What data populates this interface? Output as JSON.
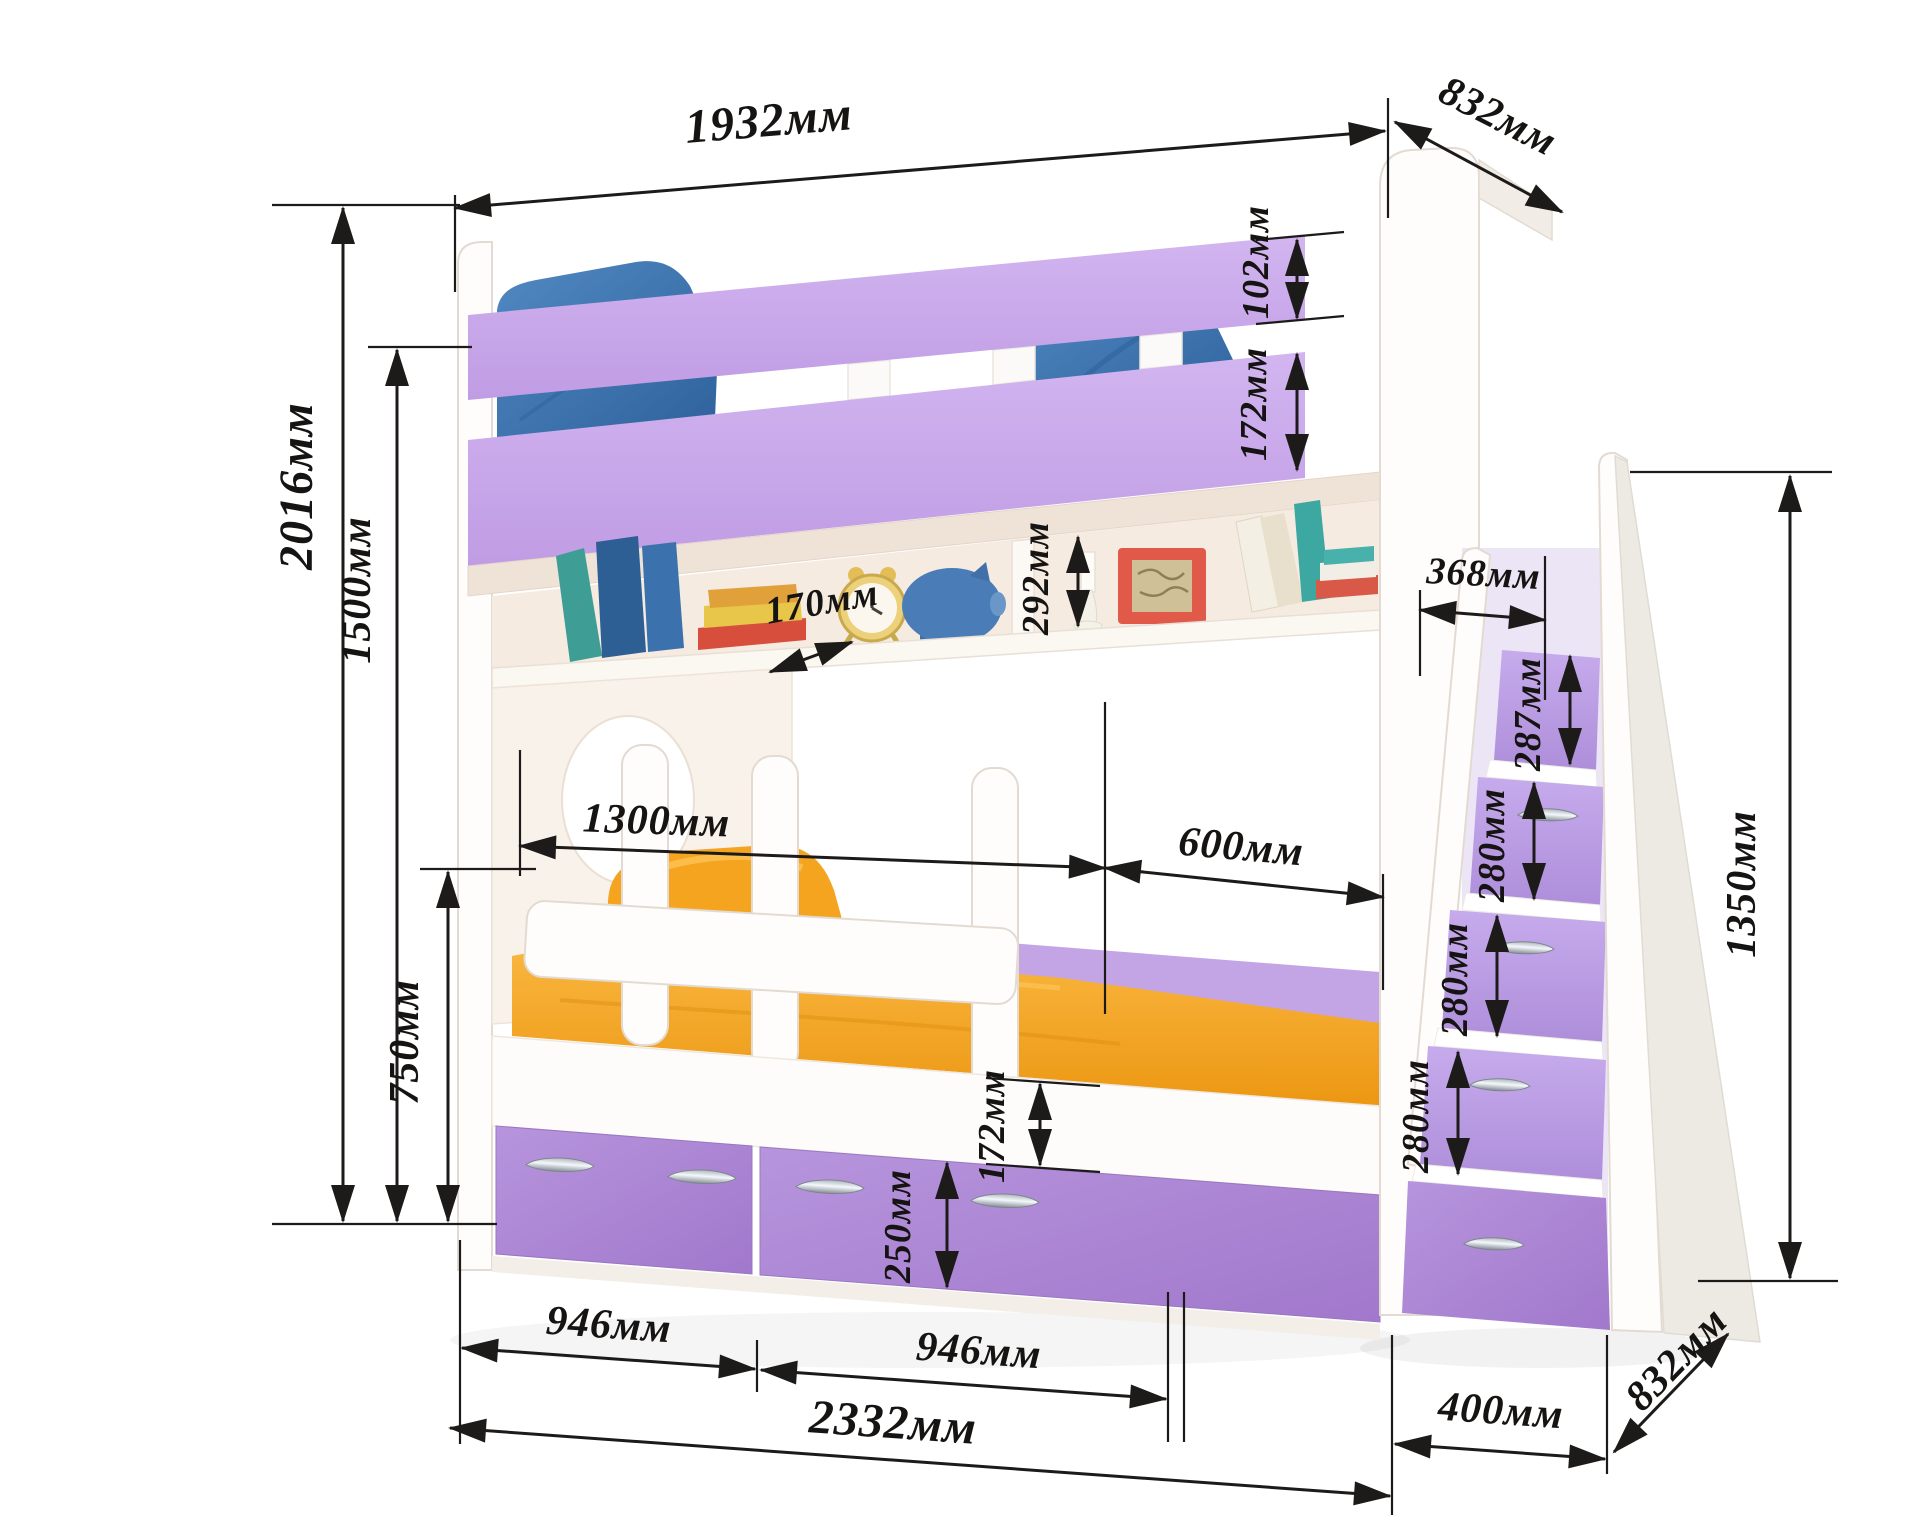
{
  "diagram": {
    "subject": "bunk-bed-with-ladder-drawers",
    "unit": "мм",
    "dimensions": {
      "top_length": "1932мм",
      "top_depth": "832мм",
      "upper_rail_top": "102мм",
      "upper_rail_main": "172мм",
      "height_total": "2016мм",
      "height_upper_bed": "1500мм",
      "height_guard": "750мм",
      "shelf_depth": "170мм",
      "shelf_opening": "292мм",
      "guard_length": "1300мм",
      "entry_gap": "600мм",
      "bed_base": "172мм",
      "drawer_front": "250мм",
      "drawer_left": "946мм",
      "drawer_right": "946мм",
      "length_total": "2332мм",
      "ladder_width": "400мм",
      "ladder_depth": "832мм",
      "ladder_top_depth": "368мм",
      "step_1": "287мм",
      "step_2": "280мм",
      "step_3": "280мм",
      "step_4": "280мм",
      "ladder_height": "1350мм"
    },
    "colors": {
      "rail_purple": "#c7a6e9",
      "drawer_purple": "#ab86d3",
      "step_purple": "#ba9ce4",
      "mattress_orange": "#f3a220",
      "pillow_blue": "#3f78b4",
      "dimension_ink": "#1d1b19"
    }
  }
}
